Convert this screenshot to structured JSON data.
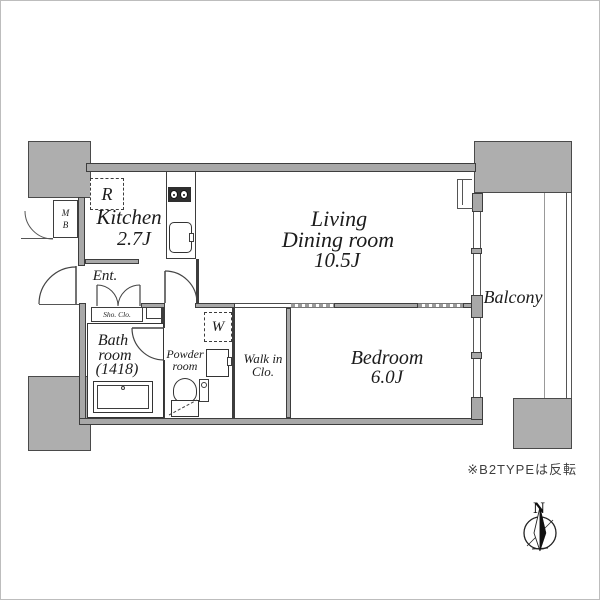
{
  "floorplan": {
    "rooms": {
      "kitchen": {
        "name": "Kitchen",
        "size": "2.7J"
      },
      "living": {
        "line1": "Living",
        "line2": "Dining room",
        "size": "10.5J"
      },
      "bedroom": {
        "name": "Bedroom",
        "size": "6.0J"
      },
      "bathroom": {
        "line1": "Bath",
        "line2": "room",
        "size": "(1418)"
      },
      "powder": {
        "line1": "Powder",
        "line2": "room"
      },
      "walkin": {
        "line1": "Walk in",
        "line2": "Clo."
      },
      "balcony": {
        "name": "Balcony"
      },
      "entrance": {
        "name": "Ent."
      },
      "shoe_closet": {
        "name": "Sho. Clo."
      }
    },
    "fixtures": {
      "refrigerator": "R",
      "washer": "W",
      "meter_box_top": "M",
      "meter_box_bottom": "B"
    },
    "note": "※B2TYPEは反転",
    "compass": {
      "north": "N"
    },
    "colors": {
      "wall_fill": "#a8a8a8",
      "concrete_fill": "#aeaeae",
      "line": "#3d3d3d",
      "background": "#ffffff"
    }
  }
}
